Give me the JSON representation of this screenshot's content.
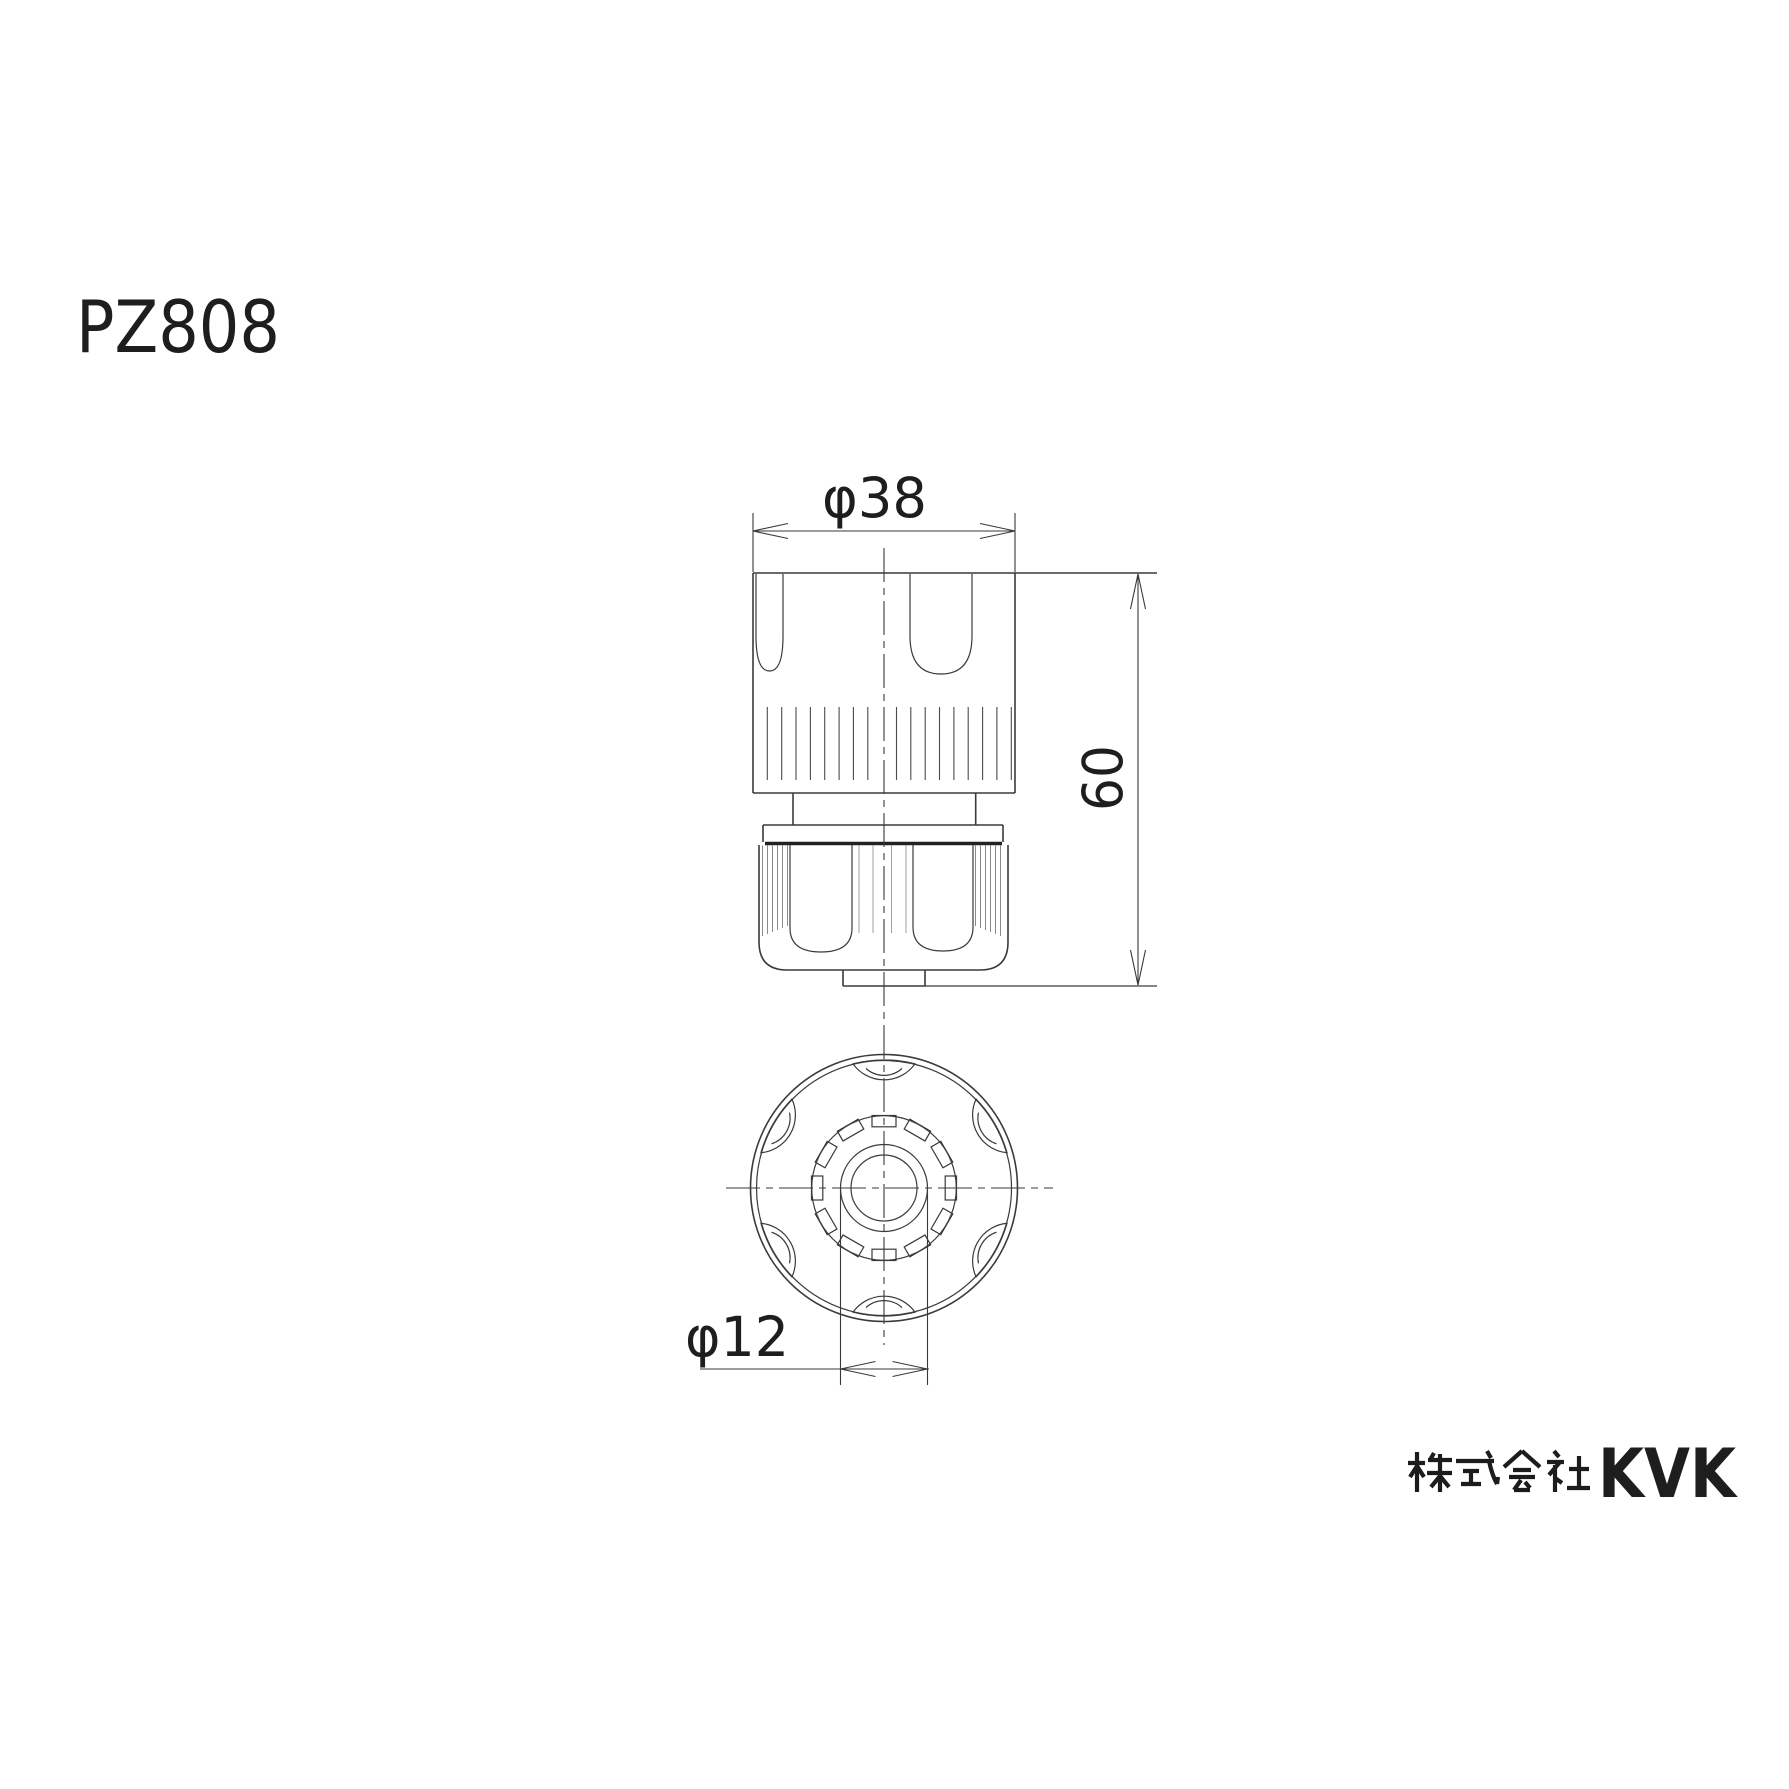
{
  "page": {
    "background": "#ffffff",
    "line_color": "#3a3a3a",
    "text_color": "#1e1e1e"
  },
  "title": {
    "model": "PZ808"
  },
  "dimensions": {
    "body_width": {
      "label": "φ38",
      "symbol": "φ",
      "value": 38
    },
    "overall_height": {
      "label": "60",
      "value": 60
    },
    "outlet_diameter": {
      "label": "φ12",
      "symbol": "φ",
      "value": 12
    }
  },
  "footer": {
    "company_prefix": "株式会社",
    "brand": "KVK"
  }
}
